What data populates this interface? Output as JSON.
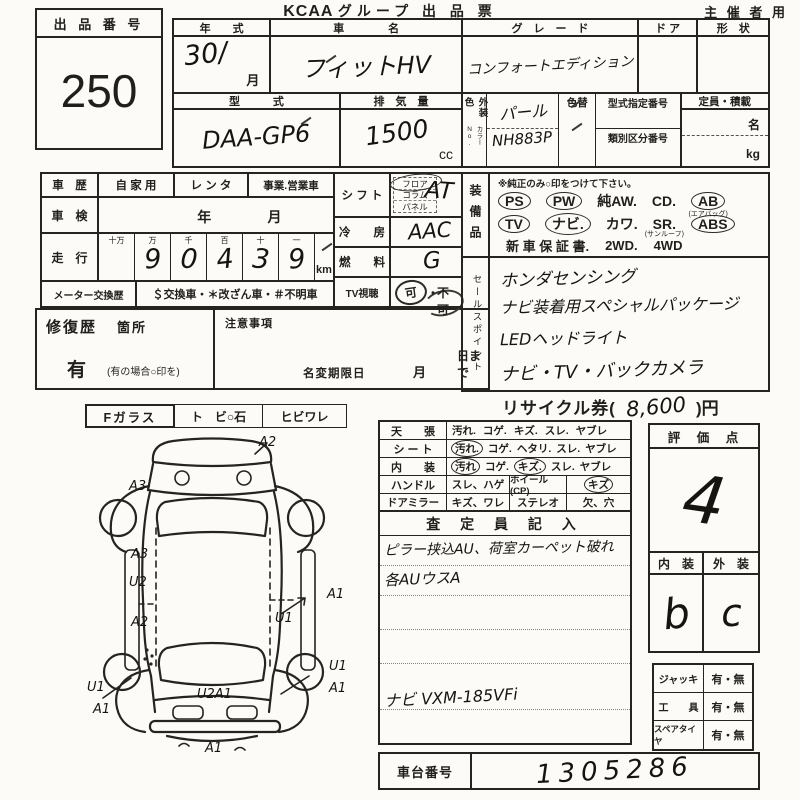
{
  "header": {
    "brand": "KCAA",
    "title": "グループ 出 品 票",
    "audience": "主 催 者 用"
  },
  "lot": {
    "label": "出 品 番 号",
    "number": "250"
  },
  "vehicle": {
    "year_label": "年　　式",
    "year_value": "30/",
    "month_suffix": "月",
    "name_label": "車　　　　名",
    "name_value": "フィットHV",
    "grade_label": "グ　レ　ー　ド",
    "grade_value": "コンフォートエディション",
    "door_label": "ド ア",
    "shape_label": "形　状",
    "model_label": "型　　　式",
    "model_value": "DAA-GP6",
    "disp_label": "排　気　量",
    "disp_value": "1500",
    "disp_unit": "cc",
    "color_label": "外装色",
    "color_no_label": "カラーNo.",
    "color_value": "パール",
    "color_no_value": "NH883P",
    "recolor_label": "色替",
    "typeno_label": "型式指定番号",
    "classno_label": "類別区分番号",
    "capacity_label": "定員・積載",
    "capacity_persons": "名",
    "capacity_weight": "kg"
  },
  "history": {
    "usage_label": "車　歴",
    "usage_options": [
      "自 家 用",
      "レ ン タ",
      "事業.営業車"
    ],
    "shaken_label": "車　検",
    "shaken_year": "年",
    "shaken_month": "月",
    "mileage_label": "走　行",
    "mileage_headers": [
      "十万",
      "万",
      "千",
      "百",
      "十",
      "一"
    ],
    "mileage_digits": [
      "",
      "9",
      "0",
      "4",
      "3",
      "9"
    ],
    "mileage_unit": "km",
    "meter_label": "メーター交換歴",
    "meter_options": "＄交換車・＊改ざん車・＃不明車"
  },
  "repair": {
    "label": "修復歴",
    "spots": "箇所",
    "has": "有",
    "hint": "(有の場合○印を)"
  },
  "notes": {
    "label": "注意事項",
    "rename_label": "名変期限日",
    "month": "月",
    "day": "日まで"
  },
  "specs": {
    "shift_label": "シ フ ト",
    "shift_options": [
      "フロア",
      "コラム",
      "パネル"
    ],
    "shift_value": "AT",
    "ac_label": "冷　　房",
    "ac_value": "AAC",
    "fuel_label": "燃　　料",
    "fuel_value": "G",
    "tv_label": "TV視聴",
    "tv_ok": "可",
    "tv_sep": "・",
    "tv_ng": "不 可"
  },
  "equipment": {
    "label": "装備品",
    "note": "※純正のみ○印をつけて下さい。",
    "items": [
      {
        "text": "PS"
      },
      {
        "text": "PW"
      },
      {
        "text": "純AW."
      },
      {
        "text": "CD."
      },
      {
        "text": "AB",
        "sub": "(エアバッグ)"
      },
      {
        "text": "TV"
      },
      {
        "text": "ナビ."
      },
      {
        "text": "カワ."
      },
      {
        "text": "SR.",
        "sub": "(サンルーフ)"
      },
      {
        "text": "ABS"
      },
      {
        "text": "新 車 保 証 書."
      },
      {
        "text": "2WD."
      },
      {
        "text": "4WD"
      }
    ]
  },
  "sales_points": {
    "label": "セールスポイント",
    "lines": [
      "ホンダセンシング",
      "ナビ装着用スペシャルパッケージ",
      "LEDヘッドライト",
      "ナビ・TV・バックカメラ"
    ]
  },
  "recycle": {
    "prefix": "リサイクル券(",
    "amount": "8,600",
    "suffix": ")円"
  },
  "glass": {
    "label": "Fガラス",
    "opt1": "ト　ビ○石",
    "opt2": "ヒビワレ"
  },
  "condition": {
    "rows": [
      {
        "label": "天　　張",
        "options": [
          "汚れ.",
          "コゲ.",
          "キズ.",
          "スレ.",
          "ヤブレ"
        ]
      },
      {
        "label": "シ ー ト",
        "options": [
          "汚れ.",
          "コゲ.",
          "ヘタリ.",
          "スレ.",
          "ヤブレ"
        ]
      },
      {
        "label": "内　　装",
        "options": [
          "汚れ",
          "コゲ.",
          "キズ.",
          "スレ.",
          "ヤブレ"
        ]
      }
    ],
    "handle_label": "ハンドル",
    "handle_value": "スレ、ハゲ",
    "wheel_label": "ホイール(CP)",
    "wheel_value": "キズ",
    "mirror_label": "ドアミラー",
    "mirror_value": "キズ、ワレ",
    "stereo_label": "ステレオ",
    "stereo_value": "欠、穴",
    "assessor_header": "査 定 員 記 入",
    "note_line1": "ピラー挟込AU、荷室カーペット破れ",
    "note_line2": "各AUウスA",
    "nav_line": "ナビ VXM-185VFi"
  },
  "rating": {
    "header": "評　価　点",
    "score": "4",
    "interior_label": "内　装",
    "exterior_label": "外　装",
    "interior_value": "b",
    "exterior_value": "c"
  },
  "accessories": {
    "rows": [
      {
        "label": "ジャッキ",
        "value": "有・無"
      },
      {
        "label": "工　　具",
        "value": "有・無"
      },
      {
        "label": "スペアタイヤ",
        "value": "有・無"
      }
    ]
  },
  "chassis": {
    "label": "車台番号",
    "value": "1305286"
  },
  "diagram": {
    "labels": [
      "A2",
      "A3",
      "A3",
      "U2",
      "A2",
      "U1",
      "A1",
      "U1",
      "A1",
      "U1",
      "A1",
      "U2A1",
      "A1"
    ]
  }
}
